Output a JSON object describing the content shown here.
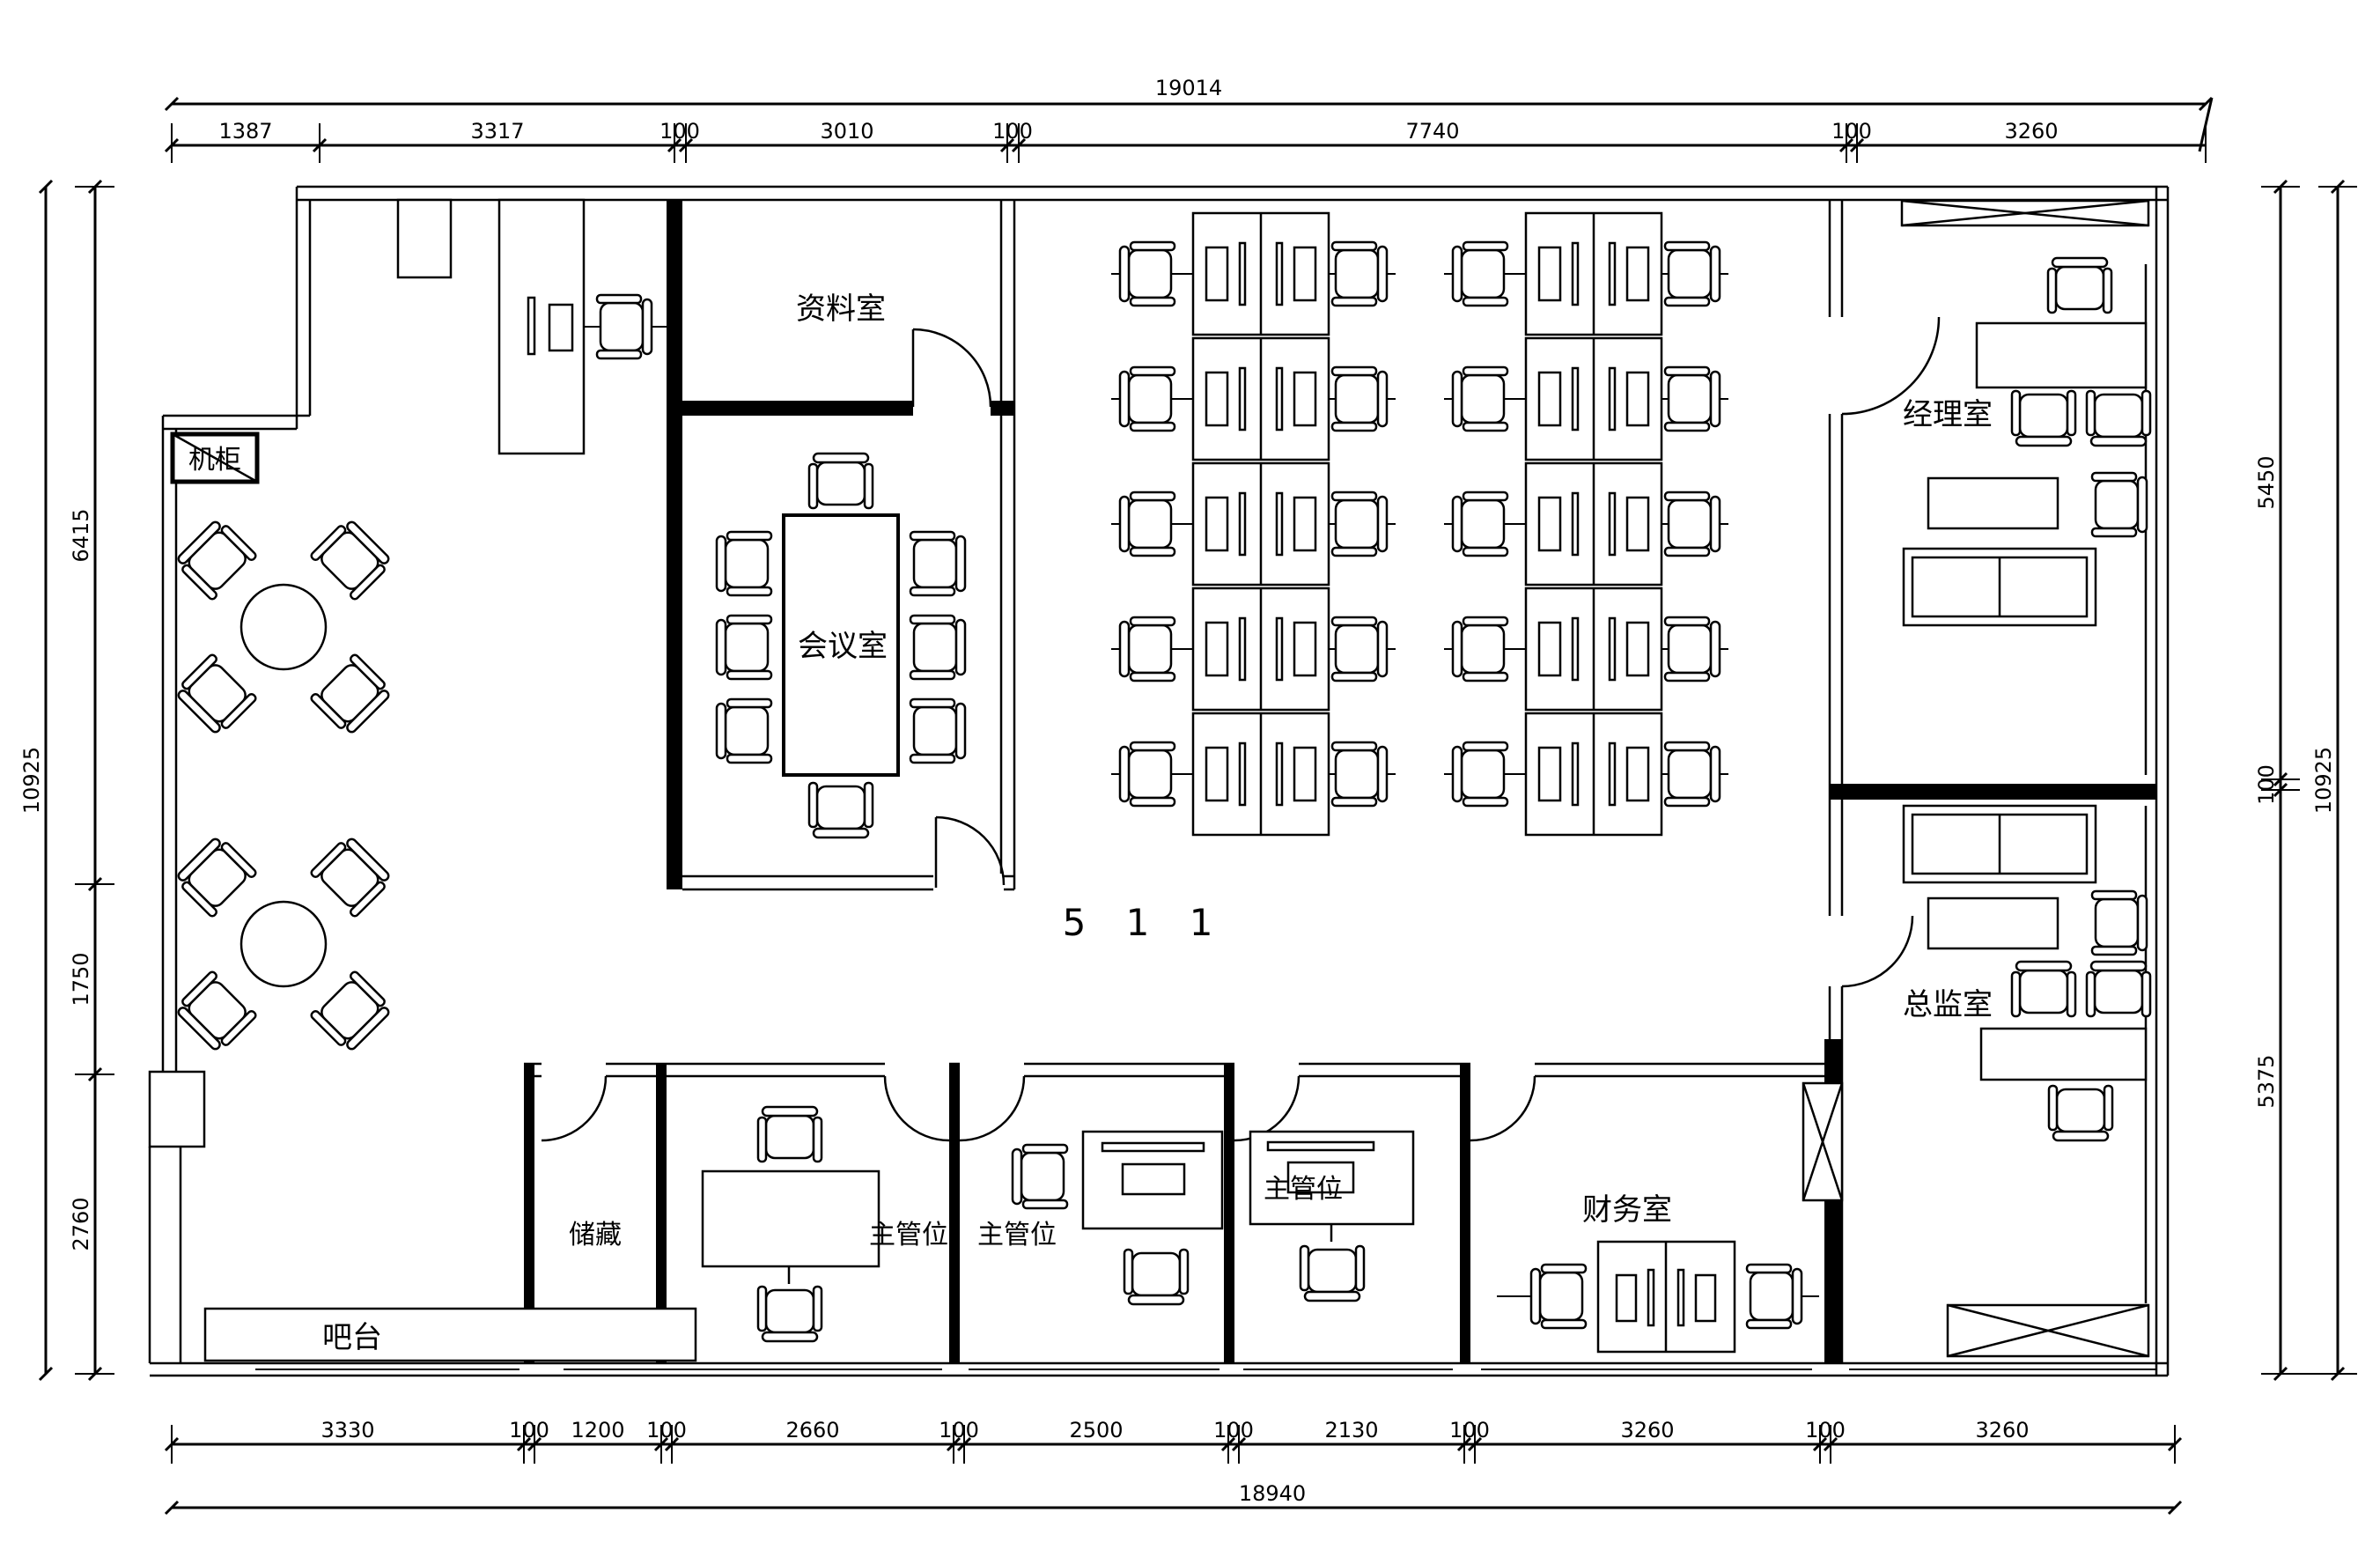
{
  "drawing": {
    "unit_label": "5 1 1"
  },
  "rooms": {
    "archive": "资料室",
    "server_cabinet": "机柜",
    "meeting": "会议室",
    "manager": "经理室",
    "director": "总监室",
    "finance": "财务室",
    "storage": "储藏",
    "supervisor": "主管位",
    "bar": "吧台"
  },
  "dimensions": {
    "top": {
      "total": "19014",
      "segments": [
        "1387",
        "3317",
        "100",
        "3010",
        "100",
        "7740",
        "100",
        "3260"
      ]
    },
    "bottom": {
      "total": "18940",
      "segments": [
        "3330",
        "100",
        "1200",
        "100",
        "2660",
        "100",
        "2500",
        "100",
        "2130",
        "100",
        "3260",
        "100",
        "3260"
      ]
    },
    "left": {
      "total": "10925",
      "segments": [
        "6415",
        "1750",
        "2760"
      ]
    },
    "right": {
      "total": "10925",
      "segments": [
        "5450",
        "100",
        "5375"
      ]
    }
  }
}
